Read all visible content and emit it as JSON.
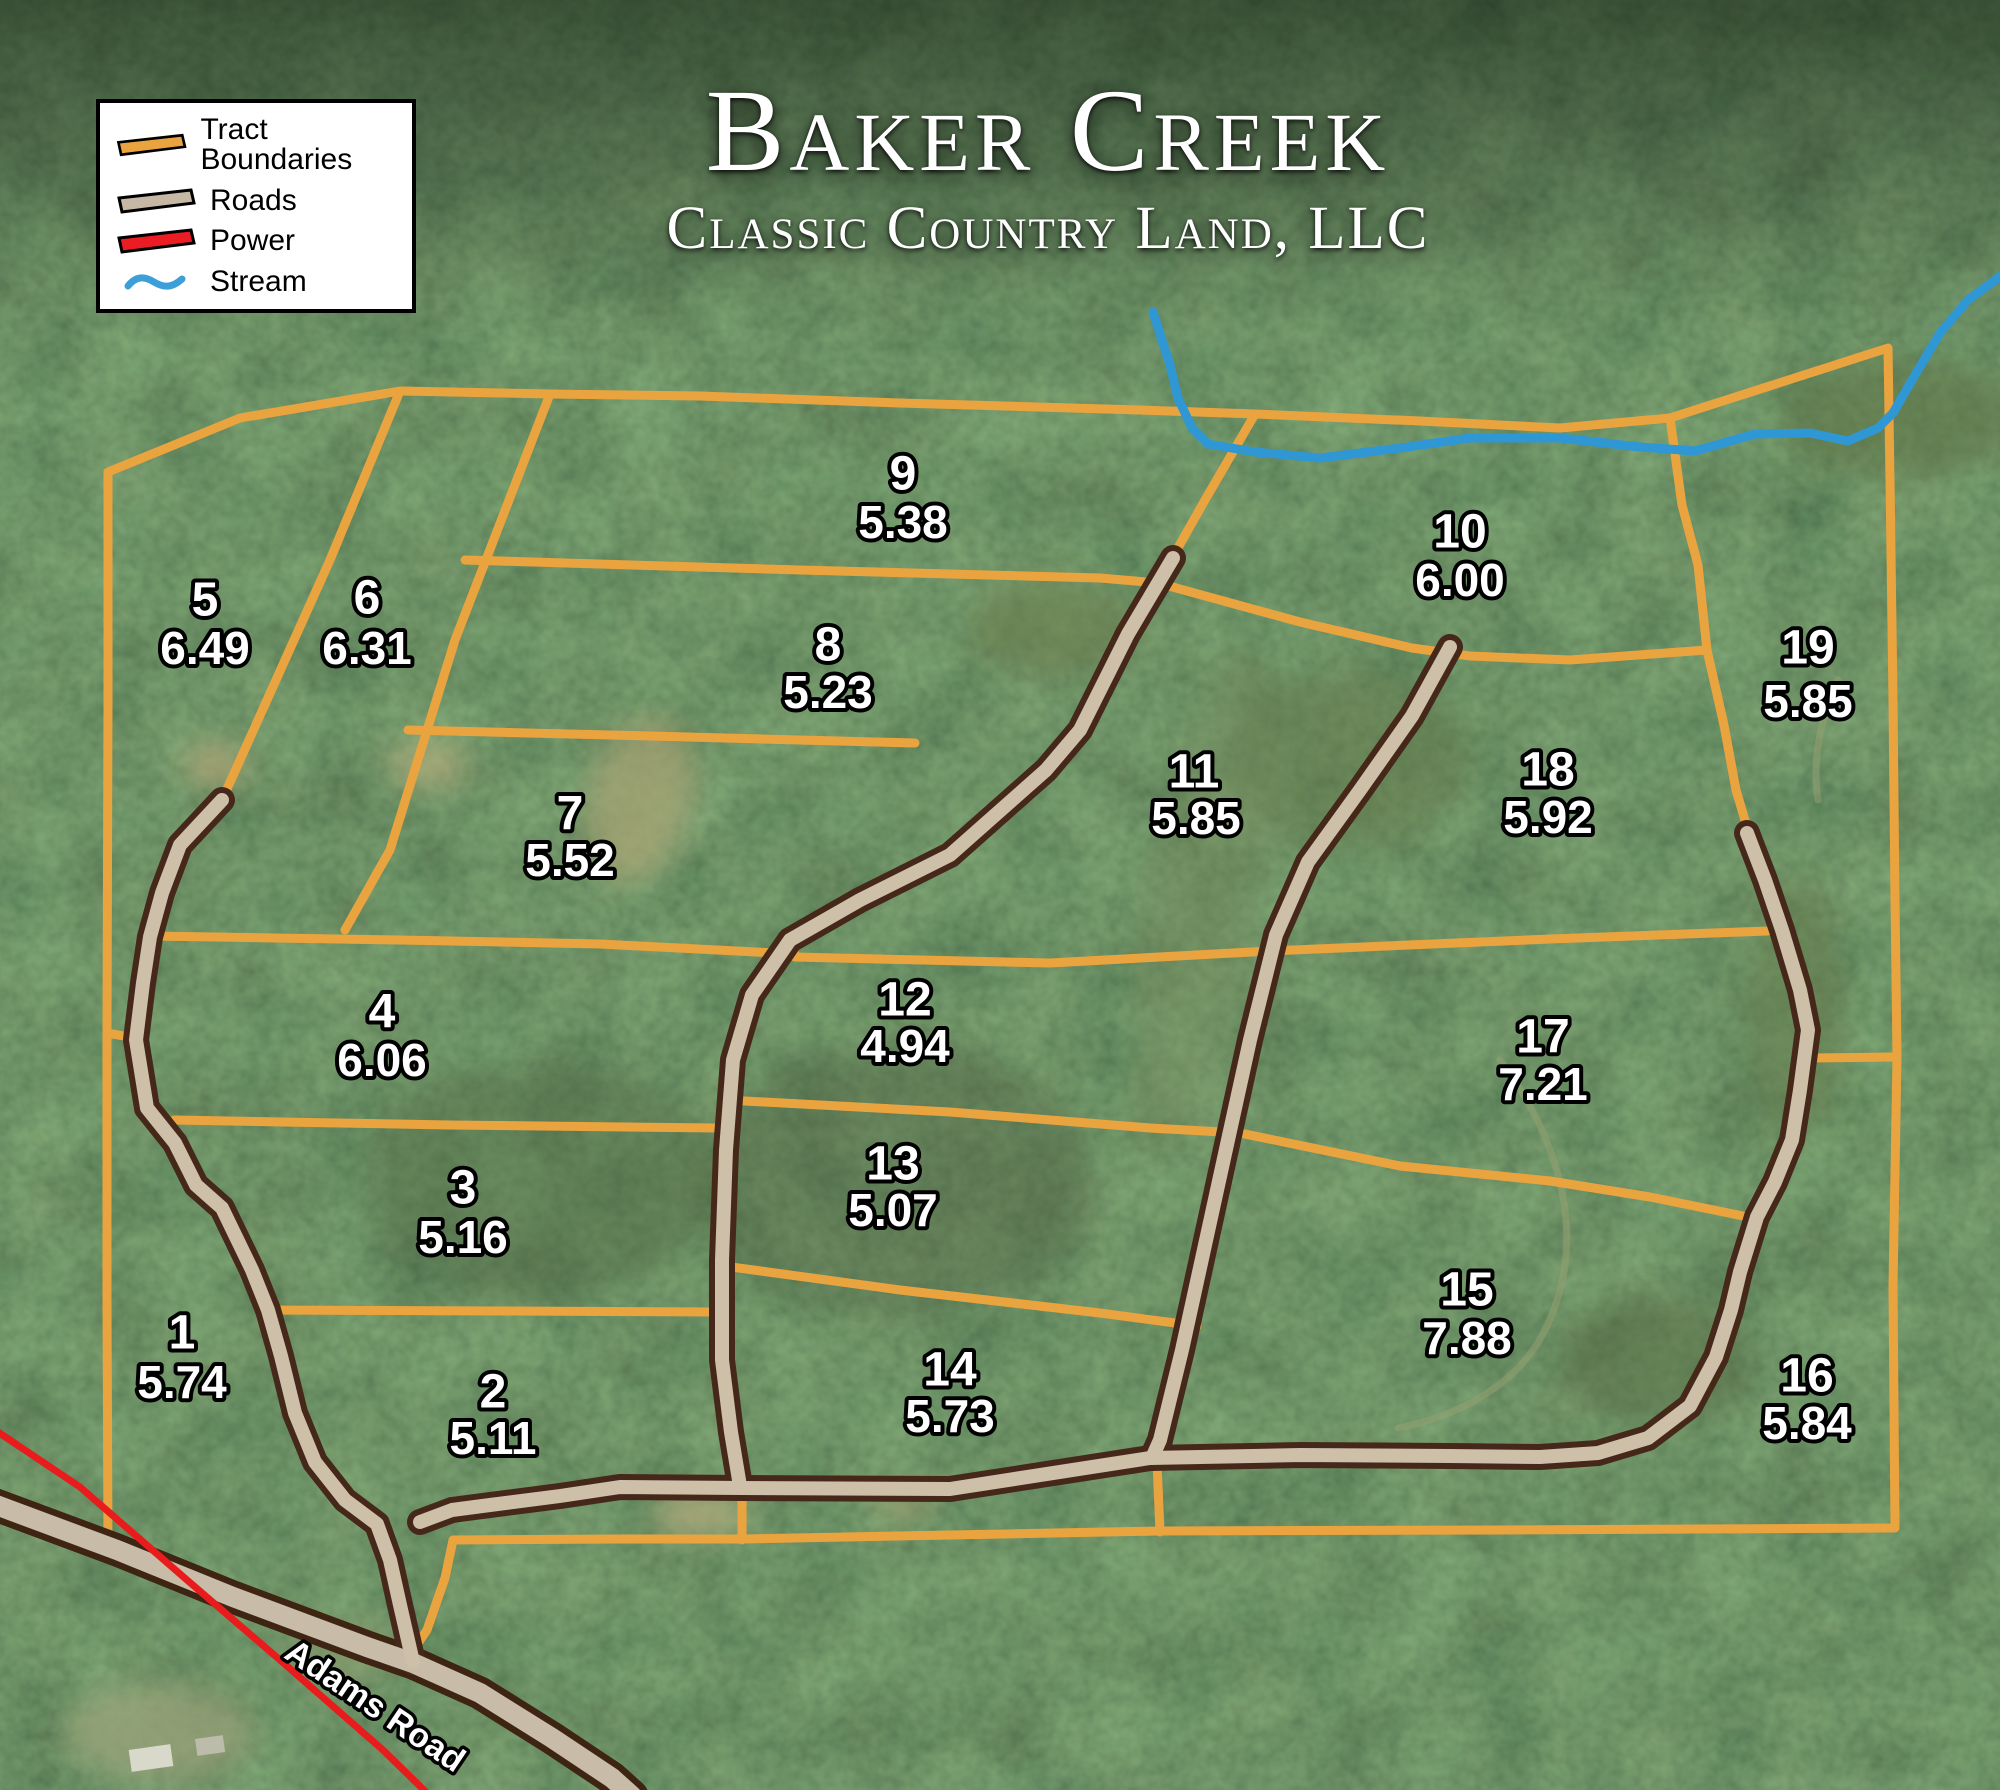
{
  "title": {
    "name": "Baker Creek",
    "company": "Classic Country Land, LLC"
  },
  "legend": {
    "items": [
      {
        "label": "Tract Boundaries",
        "type": "tract-boundary",
        "color": "#E9A440"
      },
      {
        "label": "Roads",
        "type": "road",
        "color": "#C6B8A5"
      },
      {
        "label": "Power",
        "type": "power",
        "color": "#EC1C24"
      },
      {
        "label": "Stream",
        "type": "stream",
        "color": "#3D9FD8"
      }
    ]
  },
  "map": {
    "road_label": "Adams Road"
  },
  "tracts": [
    {
      "number": "1",
      "acreage": "5.74"
    },
    {
      "number": "2",
      "acreage": "5.11"
    },
    {
      "number": "3",
      "acreage": "5.16"
    },
    {
      "number": "4",
      "acreage": "6.06"
    },
    {
      "number": "5",
      "acreage": "6.49"
    },
    {
      "number": "6",
      "acreage": "6.31"
    },
    {
      "number": "7",
      "acreage": "5.52"
    },
    {
      "number": "8",
      "acreage": "5.23"
    },
    {
      "number": "9",
      "acreage": "5.38"
    },
    {
      "number": "10",
      "acreage": "6.00"
    },
    {
      "number": "11",
      "acreage": "5.85"
    },
    {
      "number": "12",
      "acreage": "4.94"
    },
    {
      "number": "13",
      "acreage": "5.07"
    },
    {
      "number": "14",
      "acreage": "5.73"
    },
    {
      "number": "15",
      "acreage": "7.88"
    },
    {
      "number": "16",
      "acreage": "5.84"
    },
    {
      "number": "17",
      "acreage": "7.21"
    },
    {
      "number": "18",
      "acreage": "5.92"
    },
    {
      "number": "19",
      "acreage": "5.85"
    }
  ],
  "colors": {
    "tract_boundary": "#E9A440",
    "road_fill": "#CDBFA8",
    "road_casing": "#45281A",
    "power_line": "#E81C1C",
    "stream": "#2F97D3",
    "legend_background": "#FFFFFF",
    "label_fill": "#FFFFFF",
    "label_outline": "#000000"
  }
}
